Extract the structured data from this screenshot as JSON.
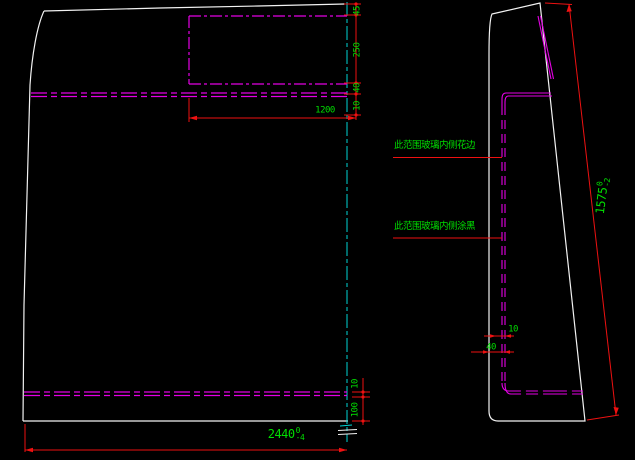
{
  "drawing": {
    "title": "glass-panel-technical-drawing",
    "colors": {
      "background": "#000000",
      "outline": "#f2f2f2",
      "frit_band": "#e400e4",
      "dimension": "#ee1111",
      "dim_text": "#00dd00",
      "centerline": "#00d4d4"
    },
    "front_view": {
      "dim_chain_right": [
        "45",
        "250",
        "40",
        "10"
      ],
      "dim_inner_width": "1200",
      "dim_chain_bottom_right": [
        "10",
        "100"
      ],
      "dim_overall_width": {
        "value": "2440",
        "tol_upper": "0",
        "tol_lower": "-4"
      }
    },
    "side_view": {
      "dim_overall_height": {
        "value": "1575",
        "tol_upper": "0",
        "tol_lower": "-2"
      },
      "dim_edge_offset": "10",
      "dim_band_width": "40",
      "note_top": "此范围玻璃内侧花边",
      "note_bottom": "此范围玻璃内侧涂黑"
    }
  }
}
